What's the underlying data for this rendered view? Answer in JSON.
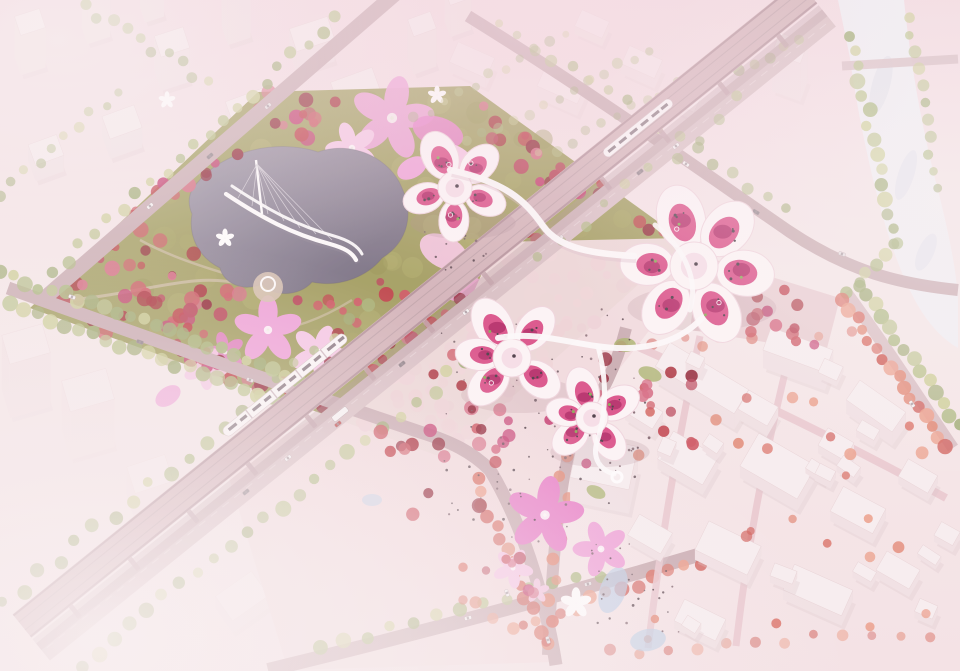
{
  "meta": {
    "description": "Aerial architectural rendering of a cherry-blossom themed park and cultural complex: a rectangular park of red blossom trees around a grey lake crossed by a white ribbon bridge, pink petal-shaped lawns, white petal-shaped pavilion buildings with magenta roof gardens, an elevated metro viaduct with white trains, a festival plaza with flower-shaped lawns and crowds, low white old-town blocks, a pale river corridor, and a faded white city context."
  },
  "palette": {
    "bg_top": "#f3dde3",
    "bg_main": "#f6eaea",
    "bg_bottom": "#f4e4e6",
    "fog": "#faf4f4",
    "city_top_face": "#f8f0f1",
    "city_front_face": "#f1e3e5",
    "city_side_face": "#e5d1d5",
    "park_ground": "#a09d5c",
    "park_ground_deep": "#8b894d",
    "lake_light": "#9b93a4",
    "lake_deep": "#716a7c",
    "bridge_white": "#fdfcfc",
    "petal_pink": "#efa2d8",
    "petal_pink_deep": "#e87fc8",
    "petal_pink_light": "#f7c9e6",
    "magenta": "#d84380",
    "magenta_deep": "#ad2360",
    "building_white": "#fdf7f8",
    "building_stroke": "#f0d6de",
    "road": "#c9adb2",
    "road_light": "#d9c1c5",
    "viaduct_deck": "#d3b4b9",
    "viaduct_edge": "#b3929a",
    "pier": "#c1a1a8",
    "river": "#f0f1f5",
    "river_shade": "#dfe3ed",
    "pond": "#b9cfe7",
    "plaza": "#e9cdd1",
    "plaza_light": "#f1dcde",
    "village_face": "#f5ebeb",
    "village_side": "#dcc6c9",
    "dot_dark": "#443640",
    "green_accent": "#86a852",
    "lawn_green": "#a8b36a",
    "people": "#5d4a52",
    "path_tan": "#d6c2b1",
    "shadow_tint": "#ab8a92",
    "train_white": "#fbf9f9",
    "train_window": "#897a82",
    "tree_reds": [
      "#a72b36",
      "#bf3a44",
      "#cd5560",
      "#8e2132",
      "#d66a82",
      "#c43a6e",
      "#b94457"
    ],
    "tree_greens": [
      "#a9b87b",
      "#b9c48a",
      "#ccd096",
      "#9cab70"
    ],
    "tree_salmons": [
      "#e28873",
      "#d96c60",
      "#ec9d87",
      "#d05c55"
    ],
    "park_greens": [
      "#95934f",
      "#a8a55f",
      "#b0ad68"
    ],
    "people_colors": [
      "#5d4a52",
      "#7a5f68",
      "#46363e"
    ],
    "car_colors": [
      "#f7f4f4",
      "#8d8188",
      "#c24b4b",
      "#e8e2e3"
    ]
  },
  "scene": {
    "landmarks": [
      "blossom-park",
      "lake",
      "ribbon-bridge",
      "petal-lawns",
      "petal-pavilion-clusters",
      "elevated-metro-viaduct",
      "metro-trains",
      "festival-plaza",
      "flower-lawns",
      "old-town-blocks",
      "river-corridor",
      "faded-city-context"
    ]
  }
}
